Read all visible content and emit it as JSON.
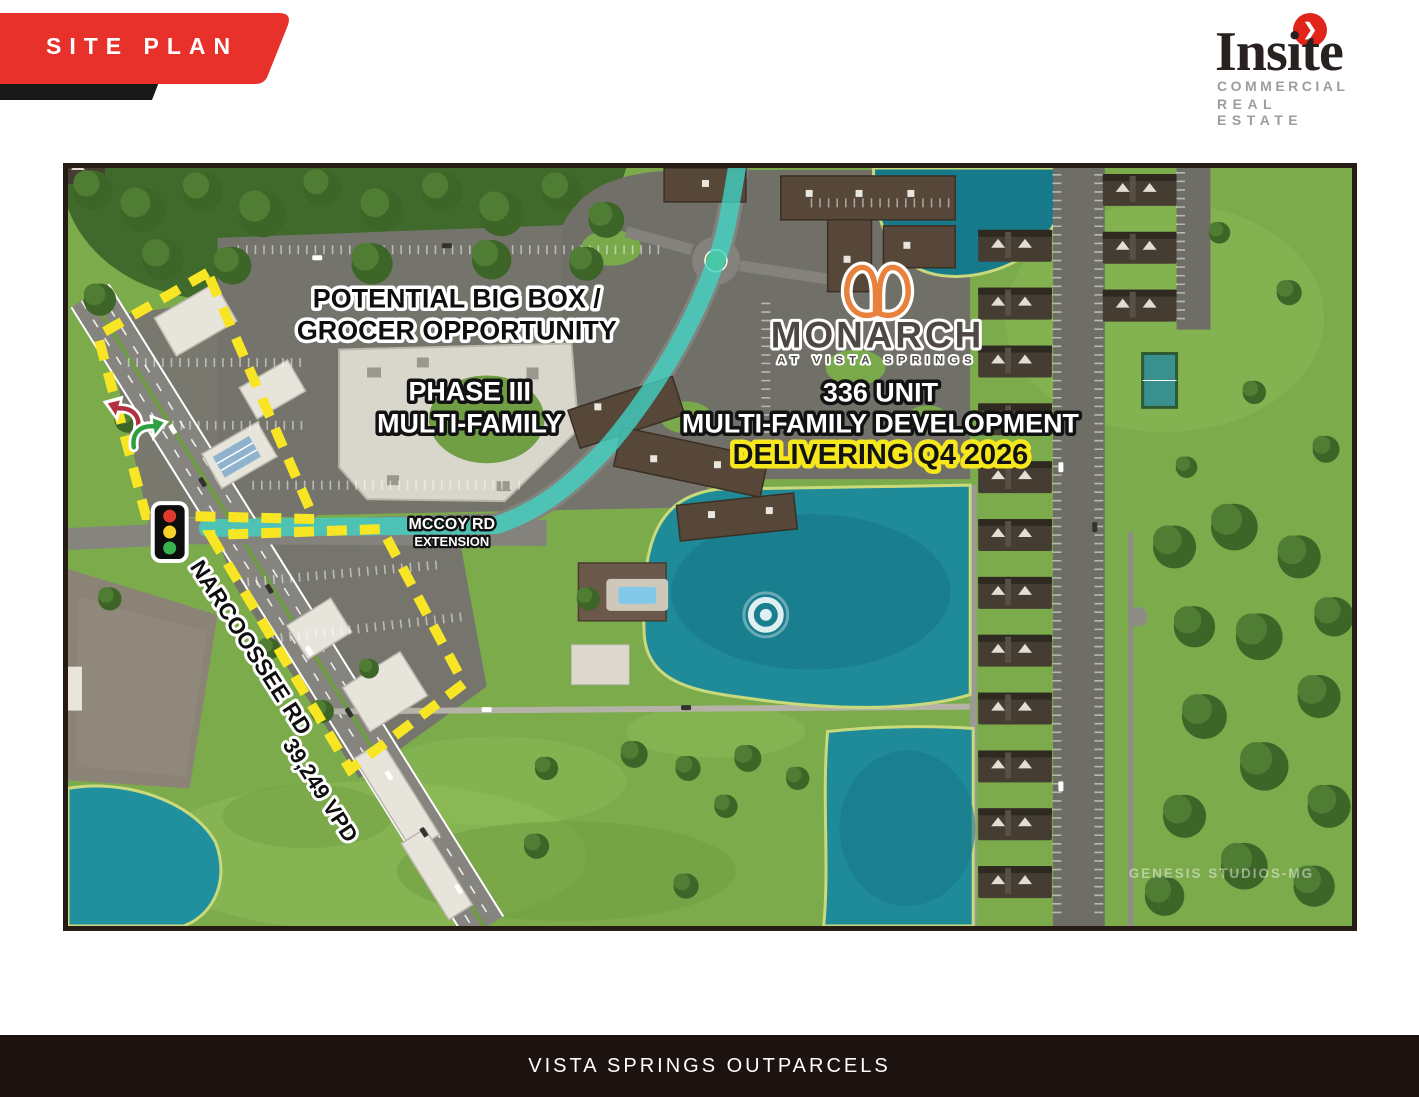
{
  "header": {
    "banner_label": "SITE PLAN",
    "logo": {
      "name": "Insite",
      "sub_line1": "COMMERCIAL",
      "sub_line2": "REAL ESTATE",
      "chevron": "❯"
    }
  },
  "map": {
    "annotations": {
      "big_box_line1": "POTENTIAL BIG BOX /",
      "big_box_line2": "GROCER OPPORTUNITY",
      "phase_line1": "PHASE III",
      "phase_line2": "MULTI-FAMILY",
      "monarch_name": "MONARCH",
      "monarch_tagline": "AT VISTA SPRINGS",
      "dev_line1": "336 UNIT",
      "dev_line2": "MULTI-FAMILY DEVELOPMENT",
      "dev_line3": "DELIVERING Q4 2026",
      "mccoy_line1": "MCCOY RD",
      "mccoy_line2": "EXTENSION",
      "road_label": "NARCOOSSEE RD",
      "traffic_count_label": "39,249 VPD",
      "watermark": "GENESIS STUDIOS-MG"
    },
    "colors": {
      "banner_red": "#e7312a",
      "boundary_yellow": "#f8e625",
      "mccoy_highlight_cyan": "#3fd5c5",
      "delivering_highlight_yellow": "#f6e81c",
      "monarch_orange": "#e8813c",
      "lake_teal": "#1f8a98",
      "footer_brown_black": "#1c1310"
    }
  },
  "footer": {
    "title": "VISTA SPRINGS OUTPARCELS"
  }
}
